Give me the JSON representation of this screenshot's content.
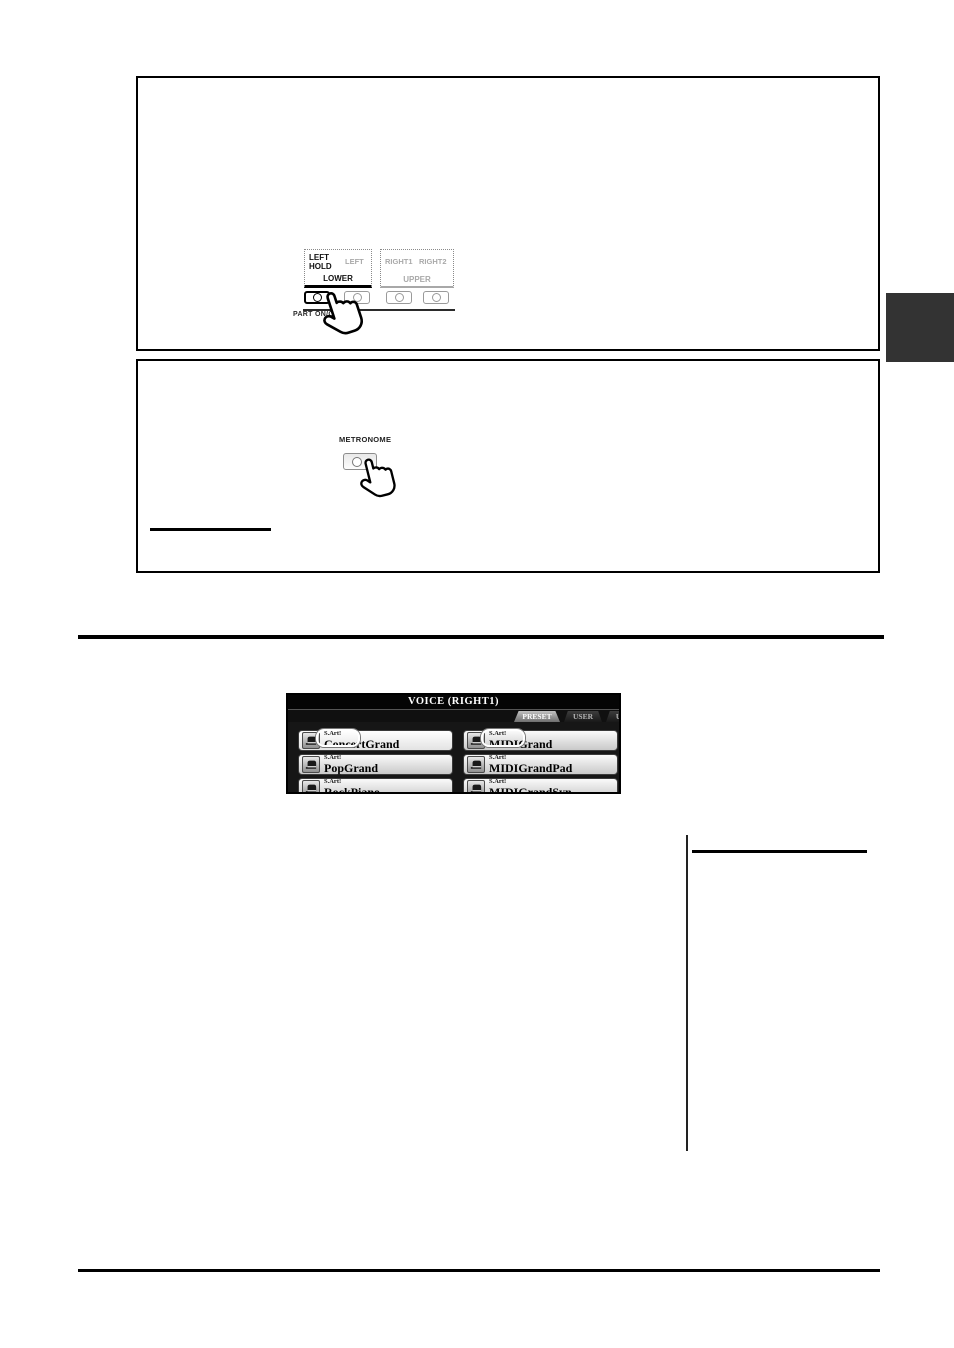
{
  "panel_diagram": {
    "left_hold_label": "LEFT\nHOLD",
    "left_label": "LEFT",
    "right1_label": "RIGHT1",
    "right2_label": "RIGHT2",
    "lower_label": "LOWER",
    "upper_label": "UPPER",
    "part_on_off_label": "PART ON/OFF",
    "buttons": [
      {
        "name": "left-hold",
        "emphasized": true
      },
      {
        "name": "left",
        "emphasized": false
      },
      {
        "name": "right1",
        "emphasized": false
      },
      {
        "name": "right2",
        "emphasized": false
      }
    ]
  },
  "metronome": {
    "label": "METRONOME"
  },
  "voice_screen": {
    "title": "VOICE (RIGHT1)",
    "tabs": [
      "PRESET",
      "USER",
      "USB1"
    ],
    "active_tab": "PRESET",
    "sart_label": "S.Art!",
    "voices": [
      {
        "name": "ConcertGrand",
        "selected": true,
        "callout": true
      },
      {
        "name": "PopGrand",
        "selected": false,
        "callout": false
      },
      {
        "name": "RockPiano",
        "selected": false,
        "callout": false
      },
      {
        "name": "MIDIGrand",
        "selected": false,
        "callout": true
      },
      {
        "name": "MIDIGrandPad",
        "selected": false,
        "callout": false
      },
      {
        "name": "MIDIGrandSyn",
        "selected": false,
        "callout": false
      }
    ]
  },
  "icons": {
    "hand_pointer": "pointing-hand-icon",
    "piano": "grand-piano-icon",
    "led": "led-indicator"
  },
  "colors": {
    "page_index_tab": "#333333",
    "screen_background": "#161616",
    "active_tab_gray": "#8d8d8d",
    "rule_black": "#000000"
  }
}
